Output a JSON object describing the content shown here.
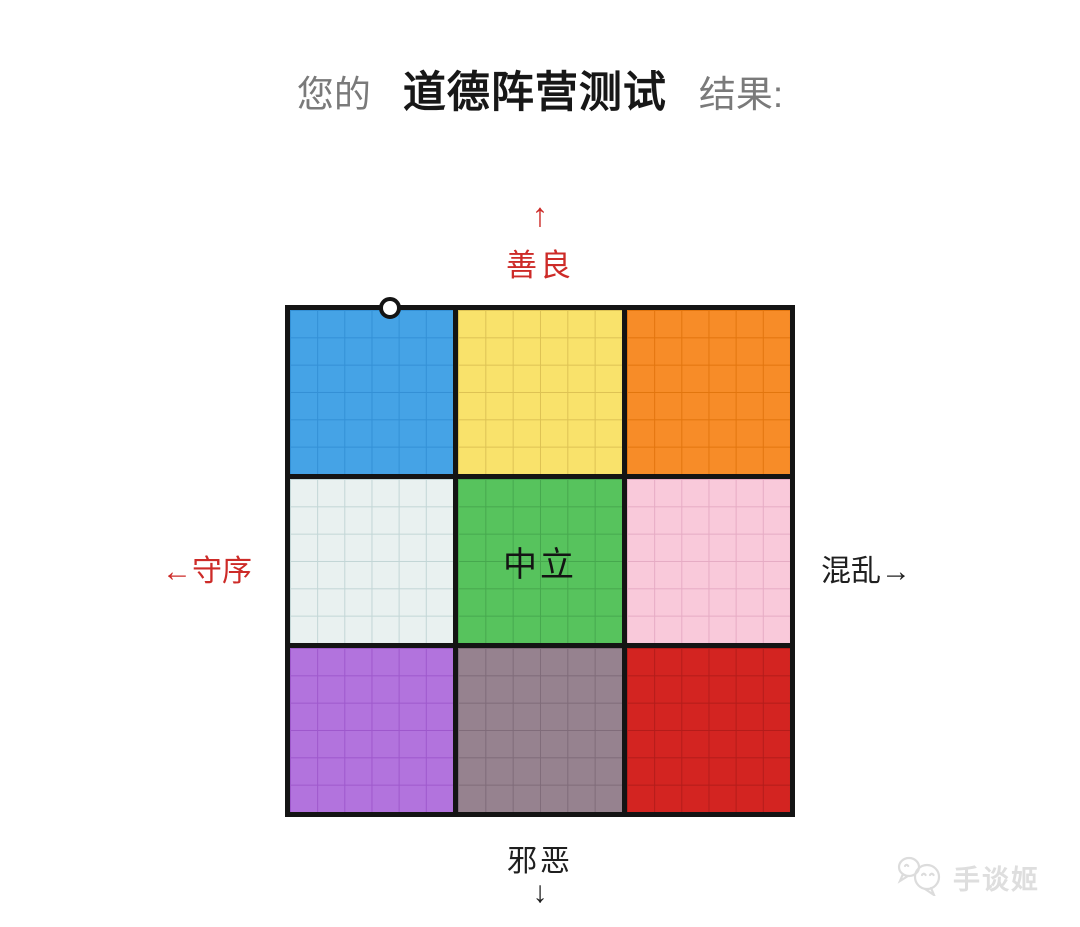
{
  "page": {
    "background_color": "#ffffff",
    "accent_red": "#cd2b28",
    "text_black": "#1f1f1f"
  },
  "title": {
    "prefix": "您的",
    "main": "道德阵营测试",
    "suffix": "结果:",
    "side_color": "#7a7a7a",
    "main_color": "#171717"
  },
  "axes": {
    "top": {
      "arrow": "↑",
      "label": "善良",
      "color": "#cd2b28"
    },
    "left": {
      "label": "←守序",
      "color": "#cd2b28"
    },
    "right": {
      "label": "混乱→",
      "color": "#1f1f1f"
    },
    "bottom": {
      "label": "邪恶",
      "arrow": "↓",
      "color": "#1f1f1f"
    }
  },
  "grid": {
    "rows": 3,
    "cols": 3,
    "subdivisions": 6,
    "border_color": "#141414",
    "cells": [
      {
        "color": "#45a3e6",
        "line_color": "#3390d6",
        "label": ""
      },
      {
        "color": "#f9e26b",
        "line_color": "#ddc254",
        "label": ""
      },
      {
        "color": "#f78c28",
        "line_color": "#e2750e",
        "label": ""
      },
      {
        "color": "#e9f1f0",
        "line_color": "#c2d6d6",
        "label": ""
      },
      {
        "color": "#57c35d",
        "line_color": "#46a84e",
        "label": "中立"
      },
      {
        "color": "#f9c9da",
        "line_color": "#e6abc4",
        "label": ""
      },
      {
        "color": "#b273dd",
        "line_color": "#9e58cc",
        "label": ""
      },
      {
        "color": "#96828f",
        "line_color": "#7f6b79",
        "label": ""
      },
      {
        "color": "#d32421",
        "line_color": "#b31c1a",
        "label": ""
      }
    ],
    "marker": {
      "shape": "circle",
      "fill": "#ffffff",
      "stroke": "#141414",
      "x_percent": 20,
      "y_percent": 0
    }
  },
  "watermark": {
    "text": "手谈姬",
    "color": "#dedede",
    "icon": "speech-bubble-faces-icon"
  },
  "chart_data": {
    "type": "heatmap",
    "title": "道德阵营测试",
    "x_axis": {
      "left_label": "←守序",
      "right_label": "混乱→"
    },
    "y_axis": {
      "top_label": "善良",
      "bottom_label": "邪恶"
    },
    "grid": {
      "rows": 3,
      "cols": 3,
      "subdivisions_per_cell": 6
    },
    "cell_colors": [
      [
        "#45a3e6",
        "#f9e26b",
        "#f78c28"
      ],
      [
        "#e9f1f0",
        "#57c35d",
        "#f9c9da"
      ],
      [
        "#b273dd",
        "#96828f",
        "#d32421"
      ]
    ],
    "visible_cell_labels": {
      "center": "中立"
    },
    "result_point": {
      "marker": "open-circle",
      "x_fraction_of_grid": 0.2,
      "y_fraction_of_grid": 0.0,
      "located_in": "top edge of top-left (lawful-good) cell"
    }
  }
}
